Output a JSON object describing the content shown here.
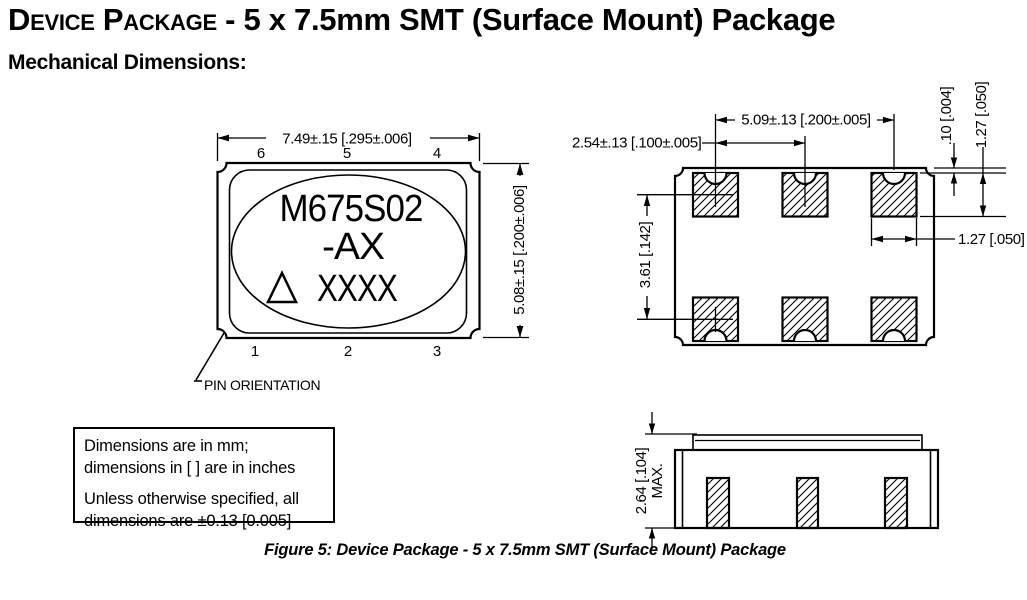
{
  "header": {
    "title_product": "Device Package",
    "title_rest": " - 5 x 7.5mm SMT (Surface Mount) Package",
    "subtitle": "Mechanical Dimensions:"
  },
  "package_top_view": {
    "width_dim": "7.49±.15 [.295±.006]",
    "height_dim": "5.08±.15 [.200±.006]",
    "pins_top": [
      "6",
      "5",
      "4"
    ],
    "pins_bottom": [
      "1",
      "2",
      "3"
    ],
    "marking": {
      "line1": "M675S02",
      "line2": "-AX",
      "line3": "XXXX"
    },
    "triangle_icon": "pin-1-index-triangle",
    "pin_orientation_label": "PIN ORIENTATION"
  },
  "land_pattern": {
    "pad_span_dim": "5.09±.13 [.200±.005]",
    "pad_pitch_dim": "2.54±.13 [.100±.005]",
    "edge_offset_dim": ".10 [.004]",
    "pad_height_dim": "1.27 [.050]",
    "pad_width_dim": "1.27 [.050]",
    "row_spacing_dim": "3.61 [.142]"
  },
  "side_view": {
    "max_height_dim": "2.64 [.104]",
    "max_suffix": "MAX."
  },
  "notes": {
    "line1": "Dimensions are in mm;",
    "line2": "dimensions in [ ] are in inches",
    "line3": "Unless otherwise specified, all",
    "line4": "dimensions are ±0.13 [0.005]"
  },
  "caption": "Figure 5: Device Package - 5 x 7.5mm SMT (Surface Mount) Package",
  "colors": {
    "ink": "#000000",
    "background": "#ffffff"
  }
}
